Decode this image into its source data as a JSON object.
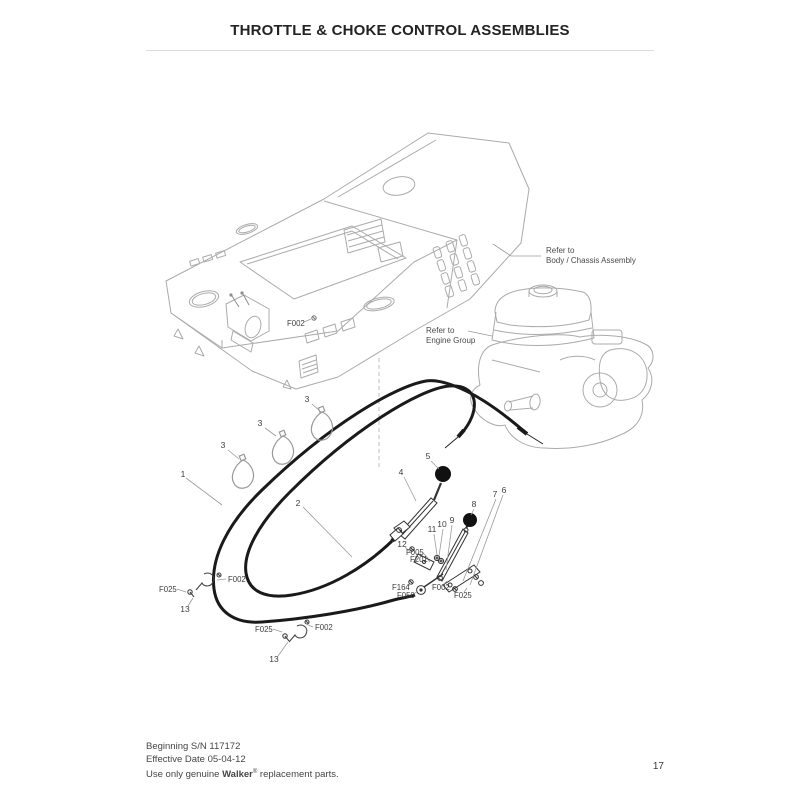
{
  "page": {
    "title": "THROTTLE & CHOKE CONTROL ASSEMBLIES",
    "page_number": "17",
    "footer_line1": "Beginning S/N 117172",
    "footer_line2": "Effective Date 05-04-12",
    "footer_line3_prefix": "Use only genuine ",
    "footer_line3_brand": "Walker",
    "footer_line3_reg": "®",
    "footer_line3_suffix": " replacement parts."
  },
  "diagram": {
    "refer_body": {
      "line1": "Refer to",
      "line2": "Body / Chassis Assembly"
    },
    "refer_engine": {
      "line1": "Refer to",
      "line2": "Engine Group"
    },
    "callouts": [
      {
        "text": "1"
      },
      {
        "text": "2"
      },
      {
        "text": "3"
      },
      {
        "text": "3"
      },
      {
        "text": "3"
      },
      {
        "text": "4"
      },
      {
        "text": "5"
      },
      {
        "text": "6"
      },
      {
        "text": "7"
      },
      {
        "text": "8"
      },
      {
        "text": "9"
      },
      {
        "text": "10"
      },
      {
        "text": "11"
      },
      {
        "text": "12"
      },
      {
        "text": "13"
      },
      {
        "text": "13"
      },
      {
        "text": "F002"
      },
      {
        "text": "F025"
      },
      {
        "text": "F002"
      },
      {
        "text": "F025"
      },
      {
        "text": "F002"
      },
      {
        "text": "F005"
      },
      {
        "text": "F201"
      },
      {
        "text": "F164"
      },
      {
        "text": "F050"
      },
      {
        "text": "F002"
      },
      {
        "text": "F025"
      }
    ],
    "colors": {
      "line_art": "#ababab",
      "cable": "#1a1a1a",
      "label_text": "#3d3d3d",
      "leader": "#9a9a9a"
    }
  }
}
